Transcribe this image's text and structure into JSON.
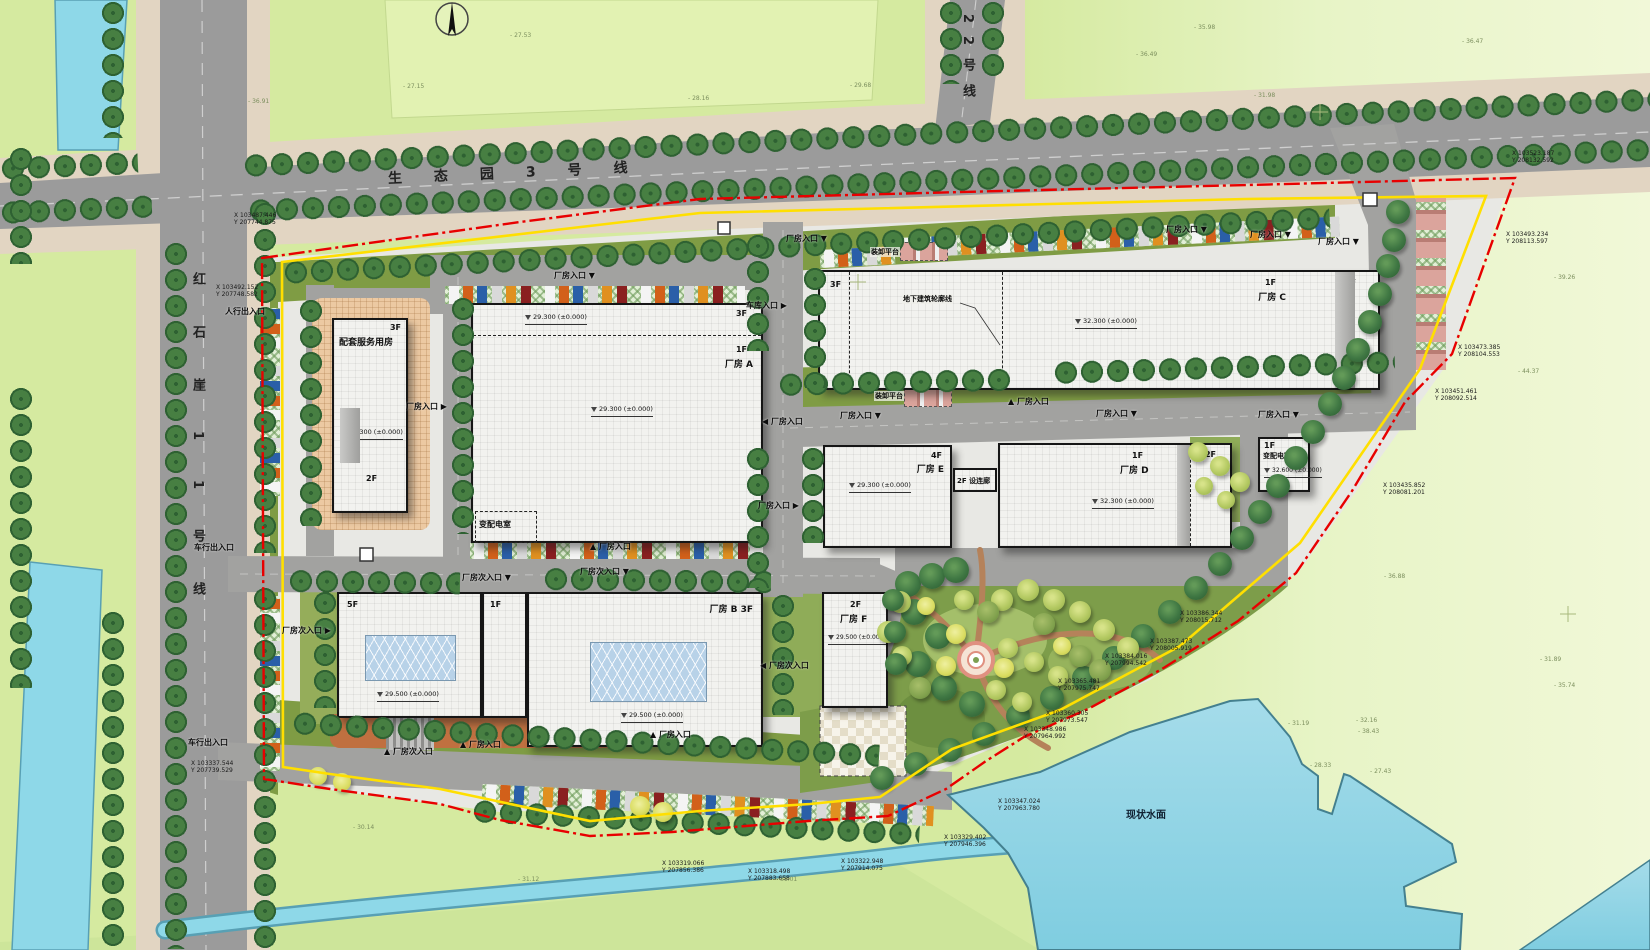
{
  "roads": {
    "top": "生态园3号线",
    "left": "红石崖11号线",
    "line22": "22号线"
  },
  "buildings": {
    "service": {
      "floors_top": "3F",
      "name": "配套服务用房",
      "elevation": "29.300 (±0.000)",
      "floors_bottom": "2F"
    },
    "factory_a": {
      "floors_corner": "3F",
      "floors": "1F",
      "name": "厂房 A",
      "elev_top": "29.300 (±0.000)",
      "elev_mid": "29.300 (±0.000)",
      "room": "变配电室"
    },
    "factory_c": {
      "floors_left": "3F",
      "floors_mid": "1F",
      "name": "厂房 C",
      "floors_right": "3F",
      "elevation": "32.300 (±0.000)"
    },
    "factory_e": {
      "floors": "4F",
      "name": "厂房 E",
      "elevation": "29.300 (±0.000)"
    },
    "corridor": {
      "label": "2F 设连廊"
    },
    "factory_d": {
      "floors": "1F",
      "name": "厂房 D",
      "floors_right": "2F",
      "elevation": "32.300 (±0.000)"
    },
    "substation": {
      "floors": "1F",
      "name": "变配电室",
      "elevation": "32.600 (±0.000)"
    },
    "tower5f": {
      "floors": "5F",
      "annex_floors": "1F",
      "elevation": "29.500 (±0.000)"
    },
    "factory_b": {
      "name": "厂房 B  3F",
      "elevation": "29.500 (±0.000)"
    },
    "factory_f": {
      "floors": "2F",
      "name": "厂房 F",
      "elevation": "29.500 (±0.000)"
    }
  },
  "water": {
    "lake": "现状水面"
  },
  "notes": [
    {
      "t": "地下建筑轮廓线",
      "s": "left:902px;top:294px"
    },
    {
      "t": "装卸平台",
      "s": "left:870px;top:247px"
    },
    {
      "t": "装卸平台",
      "s": "left:874px;top:391px"
    }
  ],
  "entrances": [
    {
      "t": "人行出入口",
      "s": "left:225px;top:306px"
    },
    {
      "t": "车行出入口",
      "s": "left:194px;top:542px"
    },
    {
      "t": "车行出入口",
      "s": "left:188px;top:737px"
    },
    {
      "t": "厂房入口 ▼",
      "s": "left:554px;top:270px"
    },
    {
      "t": "厂房入口 ▶",
      "s": "left:406px;top:401px"
    },
    {
      "t": "▲ 厂房入口",
      "s": "left:590px;top:541px"
    },
    {
      "t": "厂房入口 ▼",
      "s": "left:786px;top:233px"
    },
    {
      "t": "厂房入口 ▼",
      "s": "left:1166px;top:224px"
    },
    {
      "t": "厂房入口 ▼",
      "s": "left:1250px;top:229px"
    },
    {
      "t": "厂房入口 ▼",
      "s": "left:1318px;top:236px"
    },
    {
      "t": "车库入口 ▶",
      "s": "left:746px;top:300px"
    },
    {
      "t": "◀ 厂房入口",
      "s": "left:762px;top:416px"
    },
    {
      "t": "厂房入口 ▼",
      "s": "left:840px;top:410px"
    },
    {
      "t": "▲ 厂房入口",
      "s": "left:1008px;top:396px"
    },
    {
      "t": "厂房入口 ▼",
      "s": "left:1096px;top:408px"
    },
    {
      "t": "厂房入口 ▼",
      "s": "left:1258px;top:409px"
    },
    {
      "t": "厂房入口 ▶",
      "s": "left:758px;top:500px"
    },
    {
      "t": "厂房次入口 ▼",
      "s": "left:462px;top:572px"
    },
    {
      "t": "厂房次入口 ▼",
      "s": "left:580px;top:566px"
    },
    {
      "t": "厂房次入口 ▶",
      "s": "left:282px;top:625px"
    },
    {
      "t": "◀ 厂房次入口",
      "s": "left:760px;top:660px"
    },
    {
      "t": "▲ 厂房次入口",
      "s": "left:384px;top:746px"
    },
    {
      "t": "▲ 厂房入口",
      "s": "left:460px;top:739px"
    },
    {
      "t": "▲ 厂房入口",
      "s": "left:650px;top:729px"
    }
  ],
  "coordinates": [
    {
      "x": "X 103487.446",
      "y": "Y 207744.875",
      "s": "left:234px;top:212px"
    },
    {
      "x": "X 103492.152",
      "y": "Y 207748.582",
      "s": "left:216px;top:284px"
    },
    {
      "x": "X 103523.187",
      "y": "Y 208132.592",
      "s": "left:1512px;top:150px"
    },
    {
      "x": "X 103493.234",
      "y": "Y 208113.597",
      "s": "left:1506px;top:231px"
    },
    {
      "x": "X 103473.385",
      "y": "Y 208104.553",
      "s": "left:1458px;top:344px"
    },
    {
      "x": "X 103451.461",
      "y": "Y 208092.514",
      "s": "left:1435px;top:388px"
    },
    {
      "x": "X 103435.852",
      "y": "Y 208081.201",
      "s": "left:1383px;top:482px"
    },
    {
      "x": "X 103386.344",
      "y": "Y 208015.712",
      "s": "left:1180px;top:610px"
    },
    {
      "x": "X 103387.473",
      "y": "Y 208005.919",
      "s": "left:1150px;top:638px"
    },
    {
      "x": "X 103384.016",
      "y": "Y 207994.542",
      "s": "left:1105px;top:653px"
    },
    {
      "x": "X 103365.481",
      "y": "Y 207975.747",
      "s": "left:1058px;top:678px"
    },
    {
      "x": "X 103360.305",
      "y": "Y 207973.547",
      "s": "left:1046px;top:710px"
    },
    {
      "x": "X 103348.986",
      "y": "Y 207964.992",
      "s": "left:1024px;top:726px"
    },
    {
      "x": "X 103347.024",
      "y": "Y 207963.780",
      "s": "left:998px;top:798px"
    },
    {
      "x": "X 103329.402",
      "y": "Y 207946.396",
      "s": "left:944px;top:834px"
    },
    {
      "x": "X 103322.948",
      "y": "Y 207914.075",
      "s": "left:841px;top:858px"
    },
    {
      "x": "X 103318.498",
      "y": "Y 207883.658",
      "s": "left:748px;top:868px"
    },
    {
      "x": "X 103319.066",
      "y": "Y 207856.386",
      "s": "left:662px;top:860px"
    },
    {
      "x": "X 103337.544",
      "y": "Y 207739.529",
      "s": "left:191px;top:760px"
    }
  ],
  "spot_elevations": [
    {
      "t": "- 36.91",
      "s": "left:248px;top:98px"
    },
    {
      "t": "- 27.15",
      "s": "left:403px;top:83px"
    },
    {
      "t": "- 27.53",
      "s": "left:510px;top:32px"
    },
    {
      "t": "- 28.16",
      "s": "left:688px;top:95px"
    },
    {
      "t": "- 35.98",
      "s": "left:1194px;top:24px"
    },
    {
      "t": "- 36.47",
      "s": "left:1462px;top:38px"
    },
    {
      "t": "- 31.98",
      "s": "left:1254px;top:92px"
    },
    {
      "t": "- 36.49",
      "s": "left:1136px;top:51px"
    },
    {
      "t": "- 29.68",
      "s": "left:850px;top:82px"
    },
    {
      "t": "- 39.26",
      "s": "left:1554px;top:274px"
    },
    {
      "t": "- 44.37",
      "s": "left:1518px;top:368px"
    },
    {
      "t": "- 36.88",
      "s": "left:1384px;top:573px"
    },
    {
      "t": "- 31.89",
      "s": "left:1540px;top:656px"
    },
    {
      "t": "- 35.74",
      "s": "left:1554px;top:682px"
    },
    {
      "t": "- 38.43",
      "s": "left:1358px;top:728px"
    },
    {
      "t": "- 31.19",
      "s": "left:1288px;top:720px"
    },
    {
      "t": "- 32.16",
      "s": "left:1356px;top:717px"
    },
    {
      "t": "- 28.33",
      "s": "left:1310px;top:762px"
    },
    {
      "t": "- 27.43",
      "s": "left:1370px;top:768px"
    },
    {
      "t": "- 30.14",
      "s": "left:353px;top:824px"
    },
    {
      "t": "- 31.12",
      "s": "left:518px;top:876px"
    },
    {
      "t": "- 31.01",
      "s": "left:776px;top:876px"
    }
  ]
}
